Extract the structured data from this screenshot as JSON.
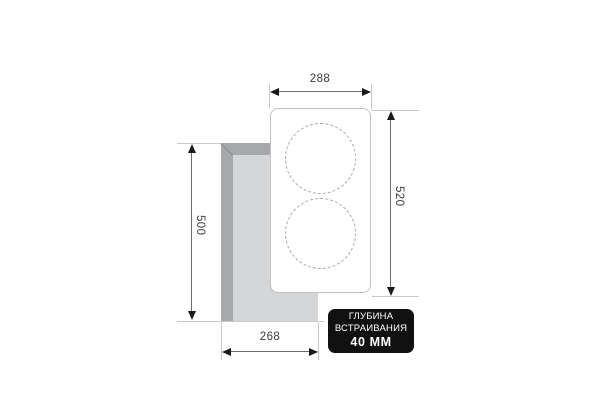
{
  "diagram": {
    "dimensions": {
      "panel_width": "288",
      "panel_height": "520",
      "cutout_height": "500",
      "cutout_width": "268"
    },
    "badge": {
      "line1": "ГЛУБИНА",
      "line2": "ВСТРАИВАНИЯ",
      "line3": "40 ММ"
    },
    "colors": {
      "badge_bg": "#111111",
      "badge_text": "#ffffff",
      "cutout_wall": "#a6a8ab",
      "cutout_floor": "#d5d6d8",
      "panel_border": "#c2c2c2",
      "burner_dash": "#a9a9a9",
      "dimension_line": "#6f6f6f",
      "extension_line": "#c9c9c9",
      "arrow": "#1a1a1a",
      "label_text": "#3c3c3c"
    }
  }
}
